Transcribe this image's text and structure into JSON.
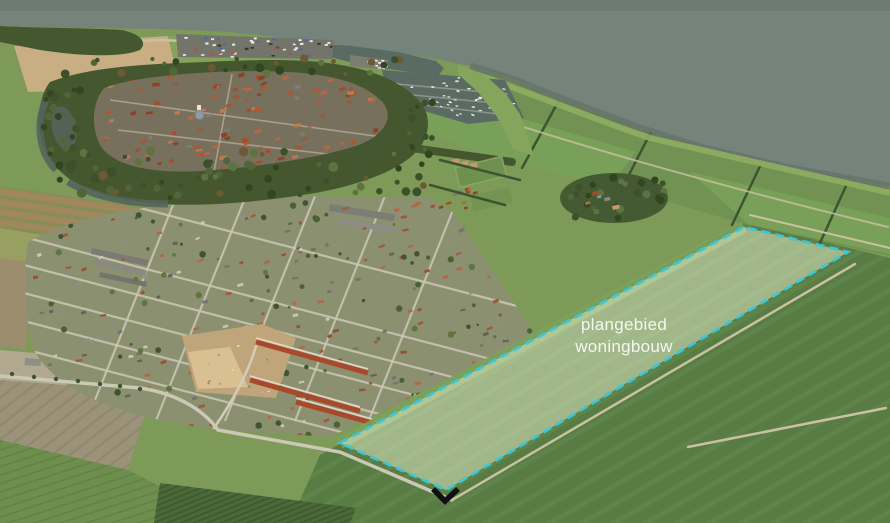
{
  "annotation": {
    "label_line1": "plangebied",
    "label_line2": "woningbouw",
    "polygon_points": "340,443 744,227 848,252 446,490",
    "marker_points": "433,489 445,501 458,489"
  },
  "colors": {
    "sea": "#75847b",
    "sea_deep": "#6b7a72",
    "shore": "#62716a",
    "dike": "#8fae60",
    "land_base": "#7e9a58",
    "field_meadow": "#719253",
    "field_right": "#587c44",
    "stripe_right": "#648c4e",
    "field_bright": "#79a058",
    "beige_field": "#c9ad83",
    "plow_brown": "#a1875d",
    "grey_field": "#9b9379",
    "rows_green": "#6e8e4e",
    "nursery": "#4a6838",
    "forest": "#44572e",
    "moat": "#55645c",
    "water_harbor": "#5a6b64",
    "town_base": "#77705c",
    "urban_base": "#8b9070",
    "road": "#ccc8b6",
    "track": "#c9c1a2",
    "roof_red": "#a8492c",
    "dirt": "#c0a47a",
    "sand": "#d9c092",
    "hedge": "#3d5430",
    "pitch": "#6f9150",
    "pool": "#5fa8c8",
    "dome": "#8d9aa6",
    "overlay_fill": "rgba(233,242,208,0.5)",
    "accent": "#3cc6d8",
    "label": "#f3f8ec",
    "marker": "#101010"
  },
  "scene": {
    "scatters": [
      {
        "target": "town-roofs",
        "shape": "rect",
        "area": [
          100,
          72,
          300,
          98
        ],
        "count": 140,
        "w": [
          3.5,
          7.5
        ],
        "h": [
          2,
          4
        ],
        "rot": -15,
        "rotJitter": 22,
        "seed": 11,
        "colors": [
          "#a34e2f",
          "#b46744",
          "#8e4126",
          "#c07a52",
          "#9c5a38",
          "#7d7d76",
          "#b3552f"
        ]
      },
      {
        "target": "res-houses",
        "shape": "rect",
        "area": [
          28,
          198,
          505,
          245
        ],
        "count": 200,
        "w": [
          3,
          6.5
        ],
        "h": [
          2,
          3.2
        ],
        "rot": -16,
        "rotJitter": 20,
        "seed": 23,
        "colors": [
          "#8f8f88",
          "#74746d",
          "#a05a3a",
          "#b06848",
          "#63635c",
          "#cac6b6",
          "#985232"
        ]
      },
      {
        "target": "res-trees",
        "shape": "circle",
        "area": [
          28,
          200,
          505,
          240
        ],
        "count": 95,
        "r": [
          1.2,
          3.4
        ],
        "seed": 31,
        "colors": [
          "#4a6134",
          "#5d7740",
          "#3f5531"
        ]
      },
      {
        "target": "belt-trees-top",
        "shape": "circle",
        "area": [
          60,
          58,
          350,
          16
        ],
        "count": 26,
        "r": [
          2,
          4.5
        ],
        "seed": 41,
        "colors": [
          "#3c512b",
          "#50663a",
          "#31461f",
          "#5d7440",
          "#6b5a32"
        ]
      },
      {
        "target": "belt-trees-left",
        "shape": "circle",
        "area": [
          40,
          84,
          42,
          110
        ],
        "count": 22,
        "r": [
          2,
          4.5
        ],
        "seed": 43,
        "colors": [
          "#3c512b",
          "#50663a",
          "#31461f"
        ]
      },
      {
        "target": "belt-trees-bottom",
        "shape": "circle",
        "area": [
          66,
          150,
          360,
          48
        ],
        "count": 60,
        "r": [
          2.2,
          5
        ],
        "seed": 47,
        "colors": [
          "#3c512b",
          "#50663a",
          "#31461f",
          "#5d7440",
          "#6b5a32"
        ]
      },
      {
        "target": "belt-trees-right",
        "shape": "circle",
        "area": [
          395,
          100,
          38,
          56
        ],
        "count": 12,
        "r": [
          2,
          4
        ],
        "seed": 53,
        "colors": [
          "#3c512b",
          "#50663a",
          "#31461f"
        ]
      },
      {
        "target": "boats",
        "shape": "rect",
        "area": [
          390,
          76,
          125,
          42
        ],
        "count": 55,
        "w": [
          2.2,
          3.4
        ],
        "h": [
          1.1,
          1.7
        ],
        "rot": 10,
        "rotJitter": 30,
        "seed": 61,
        "colors": [
          "#eef0e8",
          "#e2e6da",
          "#f6f6f0",
          "#d8dcd0"
        ]
      },
      {
        "target": "cars",
        "shape": "rect",
        "area": [
          180,
          37,
          150,
          19
        ],
        "count": 50,
        "w": [
          2.8,
          3.6
        ],
        "h": [
          1.6,
          2.1
        ],
        "rot": -4,
        "rotJitter": 8,
        "seed": 71,
        "colors": [
          "#eceae2",
          "#e4e2da",
          "#f4f2ea",
          "#c84838",
          "#4868a8",
          "#35352f",
          "#e8e8e0"
        ]
      },
      {
        "target": "boatyard",
        "shape": "rect",
        "area": [
          350,
          56,
          36,
          12
        ],
        "count": 9,
        "w": [
          2.6,
          3.4
        ],
        "h": [
          1.4,
          2
        ],
        "rot": 4,
        "rotJitter": 10,
        "seed": 77,
        "colors": [
          "#eceae2",
          "#f4f2ea"
        ]
      },
      {
        "target": "construction-bits",
        "shape": "rect",
        "area": [
          190,
          340,
          100,
          52
        ],
        "count": 18,
        "w": [
          1.5,
          3
        ],
        "h": [
          1,
          2
        ],
        "rot": 0,
        "rotJitter": 60,
        "seed": 83,
        "colors": [
          "#e8e0d0",
          "#b8b0a0",
          "#8f8778"
        ]
      },
      {
        "target": "edge-houses",
        "shape": "rect",
        "area": [
          392,
          186,
          88,
          26
        ],
        "count": 16,
        "w": [
          3.5,
          6
        ],
        "h": [
          2.2,
          3.2
        ],
        "rot": -14,
        "rotJitter": 12,
        "seed": 89,
        "colors": [
          "#a34e2f",
          "#b46744",
          "#8e4126",
          "#7d7d76"
        ]
      },
      {
        "target": "farm-trees",
        "shape": "circle",
        "area": [
          566,
          177,
          100,
          42
        ],
        "count": 26,
        "r": [
          2,
          4.2
        ],
        "seed": 97,
        "colors": [
          "#3c512b",
          "#50663a",
          "#31461f",
          "#5d7440"
        ]
      }
    ]
  }
}
